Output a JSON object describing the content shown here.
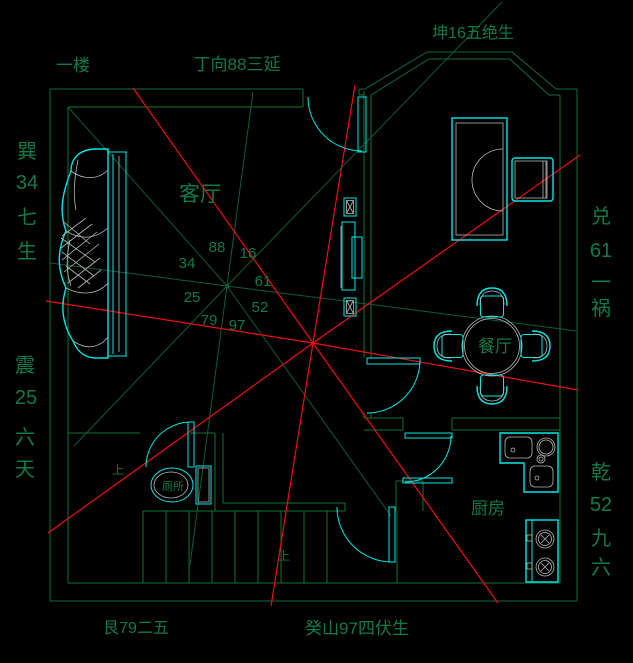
{
  "palette": {
    "bg": "#000000",
    "outline": "#0e6b3e",
    "wall": "#0b7430",
    "ray": "#0d5c36",
    "text": "#117a46",
    "cyan": "#00e6e6",
    "gray": "#b5b8b5",
    "red": "#ee0e0e"
  },
  "title_labels": {
    "floor": "一楼",
    "facing": "丁向88三延",
    "top_right": "坤16五绝生",
    "bottom_left": "艮79二五",
    "sitting": "癸山97四伏生"
  },
  "side_labels": {
    "xun": [
      "巽",
      "34",
      "七",
      "生"
    ],
    "zhen": [
      "震",
      "25",
      "六",
      "天"
    ],
    "dui": [
      "兑",
      "61",
      "一",
      "祸"
    ],
    "qian": [
      "乾",
      "52",
      "九",
      "六"
    ]
  },
  "rooms": {
    "living_room": "客厅",
    "dining_room": "餐厅",
    "kitchen": "厨房",
    "toilet": "厕所"
  },
  "stars": {
    "n": "88",
    "ne": "16",
    "w": "34",
    "e": "61",
    "sw": "25",
    "se": "52",
    "s_left": "79",
    "s": "97"
  },
  "stairs": {
    "up1": "上",
    "up2": "上"
  }
}
